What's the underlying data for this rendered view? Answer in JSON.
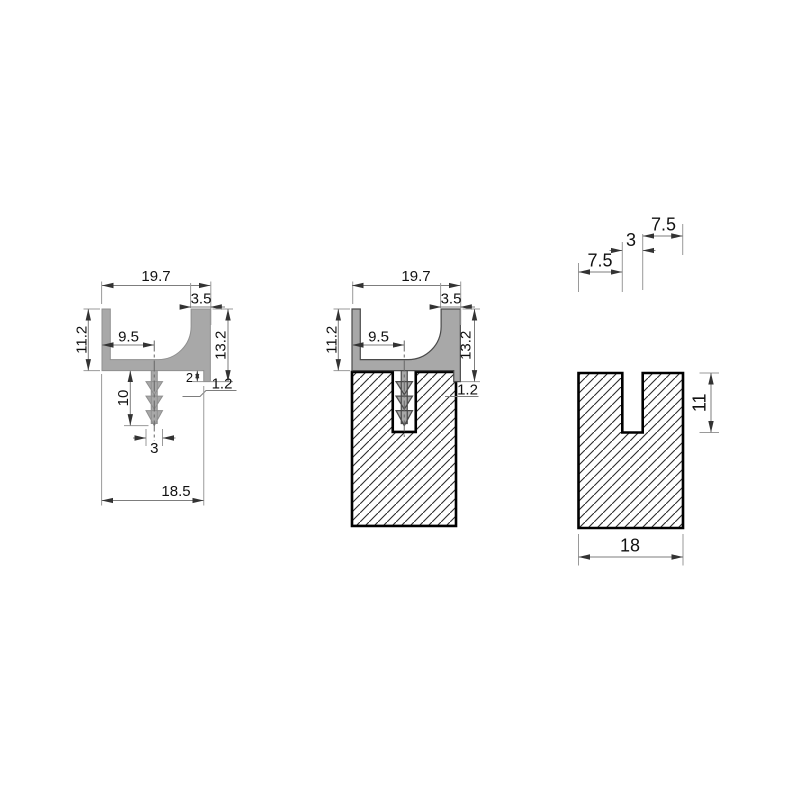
{
  "colors": {
    "profile_fill": "#a8a8a8",
    "profile_edge_left_view": "#8f8f8f",
    "profile_edge_middle_view": "#4a4a4a",
    "block_outline": "#000000",
    "hatch_line": "#2b2b2b",
    "dimension_line": "#7d7d7d",
    "extension_line": "#9a9a9a",
    "text": "#111111",
    "background": "#ffffff"
  },
  "views": {
    "left": {
      "dims": {
        "overall_top": "19.7",
        "right_wall_width": "3.5",
        "left_height": "11.2",
        "spigot_offset": "9.5",
        "right_height": "13.2",
        "step_height": "2",
        "foot_width": "1.2",
        "spigot_length": "10",
        "spigot_width": "3",
        "bottom_width": "18.5"
      }
    },
    "middle": {
      "dims": {
        "overall_top": "19.7",
        "right_wall_width": "3.5",
        "left_height": "11.2",
        "spigot_offset": "9.5",
        "right_height": "13.2",
        "foot_width": "1.2"
      }
    },
    "right": {
      "dims": {
        "top_left_segment": "7.5",
        "slot_width": "3",
        "top_right_segment": "7.5",
        "slot_depth": "11",
        "bottom_width": "18"
      }
    }
  }
}
